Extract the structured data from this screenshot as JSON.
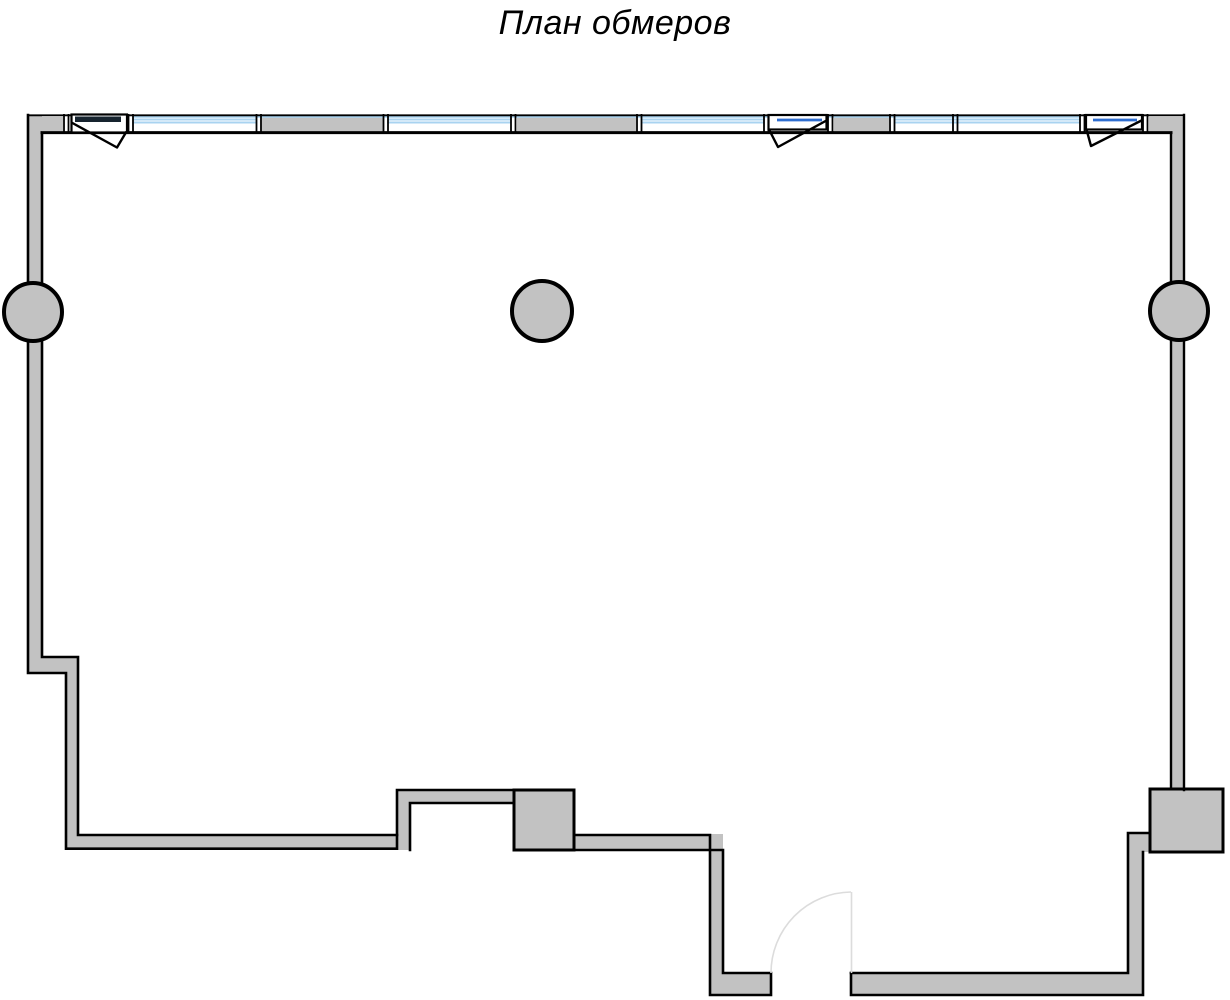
{
  "title": "План обмеров",
  "colors": {
    "background": "#ffffff",
    "wall_fill": "#c2c2c2",
    "line": "#000000",
    "glass": "#a9d3f0",
    "sash_blue": "#2f6ed0",
    "sash_dark": "#17242f",
    "door_arc": "#dcdcdc"
  },
  "plan": {
    "type": "measurement floor plan",
    "window_sections": 4,
    "casement_opening_symbols": 3,
    "round_columns": 3,
    "wall_piers": 5,
    "door_openings": 1
  }
}
